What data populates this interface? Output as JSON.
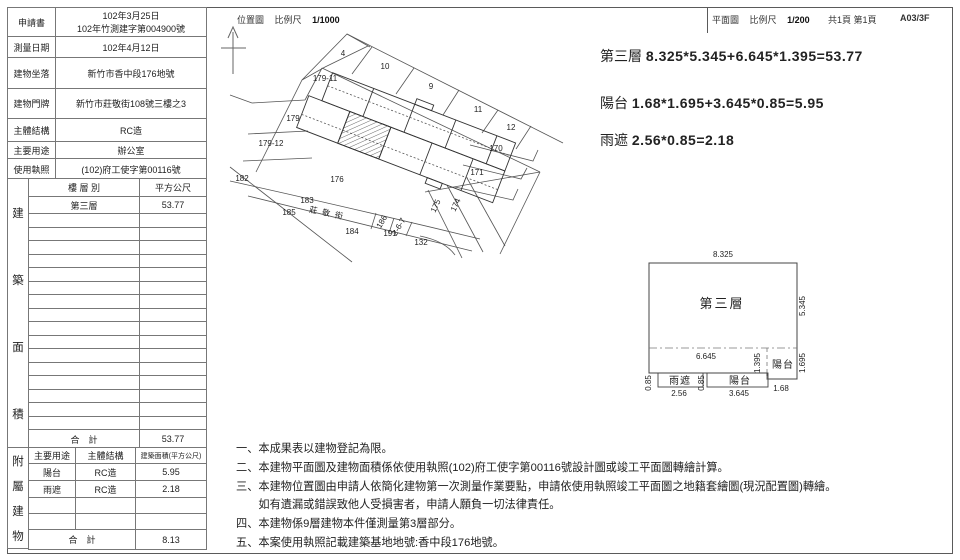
{
  "header": {
    "left_title": "位置圖",
    "left_scale_label": "比例尺",
    "left_scale": "1/1000",
    "right_title": "平面圖",
    "right_scale_label": "比例尺",
    "right_scale": "1/200",
    "pages": "共1頁 第1頁",
    "code": "A03/3F"
  },
  "info_table": {
    "rows": [
      {
        "label": "申請書",
        "value": [
          "102年3月25日",
          "102年竹測建字第004900號"
        ]
      },
      {
        "label": "測量日期",
        "value": [
          "102年4月12日"
        ]
      },
      {
        "label": "建物坐落",
        "value": [
          "新竹市香中段176地號"
        ]
      },
      {
        "label": "建物門牌",
        "value": [
          "新竹市莊敬街108號三樓之3"
        ]
      },
      {
        "label": "主體結構",
        "value": [
          "RC造"
        ]
      },
      {
        "label": "主要用途",
        "value": [
          "辦公室"
        ]
      },
      {
        "label": "使用執照",
        "value": [
          "(102)府工使字第00116號"
        ]
      }
    ]
  },
  "area_table": {
    "side_label": "建築面積",
    "col_floor": "樓 層 別",
    "col_area": "平方公尺",
    "rows": [
      {
        "floor": "第三層",
        "area": "53.77"
      }
    ],
    "empty_row_count": 16,
    "total_label": "合　計",
    "total": "53.77"
  },
  "annex_table": {
    "side_label": "附屬建物",
    "col_use": "主要用途",
    "col_structure": "主體結構",
    "col_area": "建築面積(平方公尺)",
    "rows": [
      {
        "use": "陽台",
        "structure": "RC造",
        "area": "5.95"
      },
      {
        "use": "雨遮",
        "structure": "RC造",
        "area": "2.18"
      }
    ],
    "empty_row_count": 2,
    "total_label": "合　計",
    "total": "8.13"
  },
  "formulas": [
    {
      "label": "第三層",
      "expr": "8.325*5.345+6.645*1.395=53.77"
    },
    {
      "label": "陽台",
      "expr": "1.68*1.695+3.645*0.85=5.95"
    },
    {
      "label": "雨遮",
      "expr": "2.56*0.85=2.18"
    }
  ],
  "map": {
    "street": "莊敬街",
    "lots": [
      {
        "t": "4",
        "x": 343,
        "y": 56
      },
      {
        "t": "10",
        "x": 385,
        "y": 69
      },
      {
        "t": "179-11",
        "x": 325,
        "y": 81
      },
      {
        "t": "9",
        "x": 431,
        "y": 89
      },
      {
        "t": "11",
        "x": 478,
        "y": 112
      },
      {
        "t": "179",
        "x": 293,
        "y": 121
      },
      {
        "t": "12",
        "x": 511,
        "y": 130
      },
      {
        "t": "179-12",
        "x": 271,
        "y": 146
      },
      {
        "t": "170",
        "x": 496,
        "y": 151
      },
      {
        "t": "171",
        "x": 477,
        "y": 175
      },
      {
        "t": "182",
        "x": 242,
        "y": 181
      },
      {
        "t": "176",
        "x": 337,
        "y": 182
      },
      {
        "t": "183",
        "x": 307,
        "y": 203
      },
      {
        "t": "185",
        "x": 289,
        "y": 215
      },
      {
        "t": "184",
        "x": 352,
        "y": 234
      },
      {
        "t": "191",
        "x": 390,
        "y": 236
      },
      {
        "t": "132",
        "x": 421,
        "y": 245
      },
      {
        "t": "175",
        "x": 438,
        "y": 207,
        "r": -65
      },
      {
        "t": "174",
        "x": 458,
        "y": 206,
        "r": -65
      },
      {
        "t": "186",
        "x": 384,
        "y": 223,
        "r": -60,
        "s": 4.5
      },
      {
        "t": "2-6-7",
        "x": 401,
        "y": 228,
        "r": -60,
        "s": 4.5
      },
      {
        "t": "莊敬街",
        "x": 328,
        "y": 216,
        "r": 12,
        "s": 8,
        "ls": 5
      }
    ]
  },
  "plan": {
    "labels": [
      {
        "t": "8.325",
        "x": 723,
        "y": 257
      },
      {
        "t": "5.345",
        "x": 805,
        "y": 306,
        "r": -90
      },
      {
        "t": "第三層",
        "x": 722,
        "y": 308,
        "cls": "big"
      },
      {
        "t": "6.645",
        "x": 706,
        "y": 359
      },
      {
        "t": "1.395",
        "x": 760,
        "y": 363,
        "r": -90
      },
      {
        "t": "陽台",
        "x": 783,
        "y": 368,
        "cls": "med"
      },
      {
        "t": "1.695",
        "x": 805,
        "y": 363,
        "r": -90
      },
      {
        "t": "雨遮",
        "x": 680,
        "y": 384,
        "cls": "med"
      },
      {
        "t": "0.85",
        "x": 651,
        "y": 383,
        "r": -90
      },
      {
        "t": "0.85",
        "x": 704,
        "y": 383,
        "r": -90
      },
      {
        "t": "陽台",
        "x": 740,
        "y": 384,
        "cls": "med"
      },
      {
        "t": "2.56",
        "x": 679,
        "y": 396
      },
      {
        "t": "3.645",
        "x": 739,
        "y": 396
      },
      {
        "t": "1.68",
        "x": 781,
        "y": 391
      }
    ]
  },
  "notes": [
    "一、本成果表以建物登記為限。",
    "二、本建物平面圖及建物面積係依使用執照(102)府工使字第00116號設計圖或竣工平面圖轉繪計算。",
    "三、本建物位置圖由申請人依簡化建物第一次測量作業要點，申請依使用執照竣工平面圖之地籍套繪圖(現況配置圖)轉繪。",
    "　　如有遺漏或錯誤致他人受損害者，申請人願負一切法律責任。",
    "四、本建物係9層建物本件僅測量第3層部分。",
    "五、本案使用執照記載建築基地地號:香中段176地號。"
  ]
}
